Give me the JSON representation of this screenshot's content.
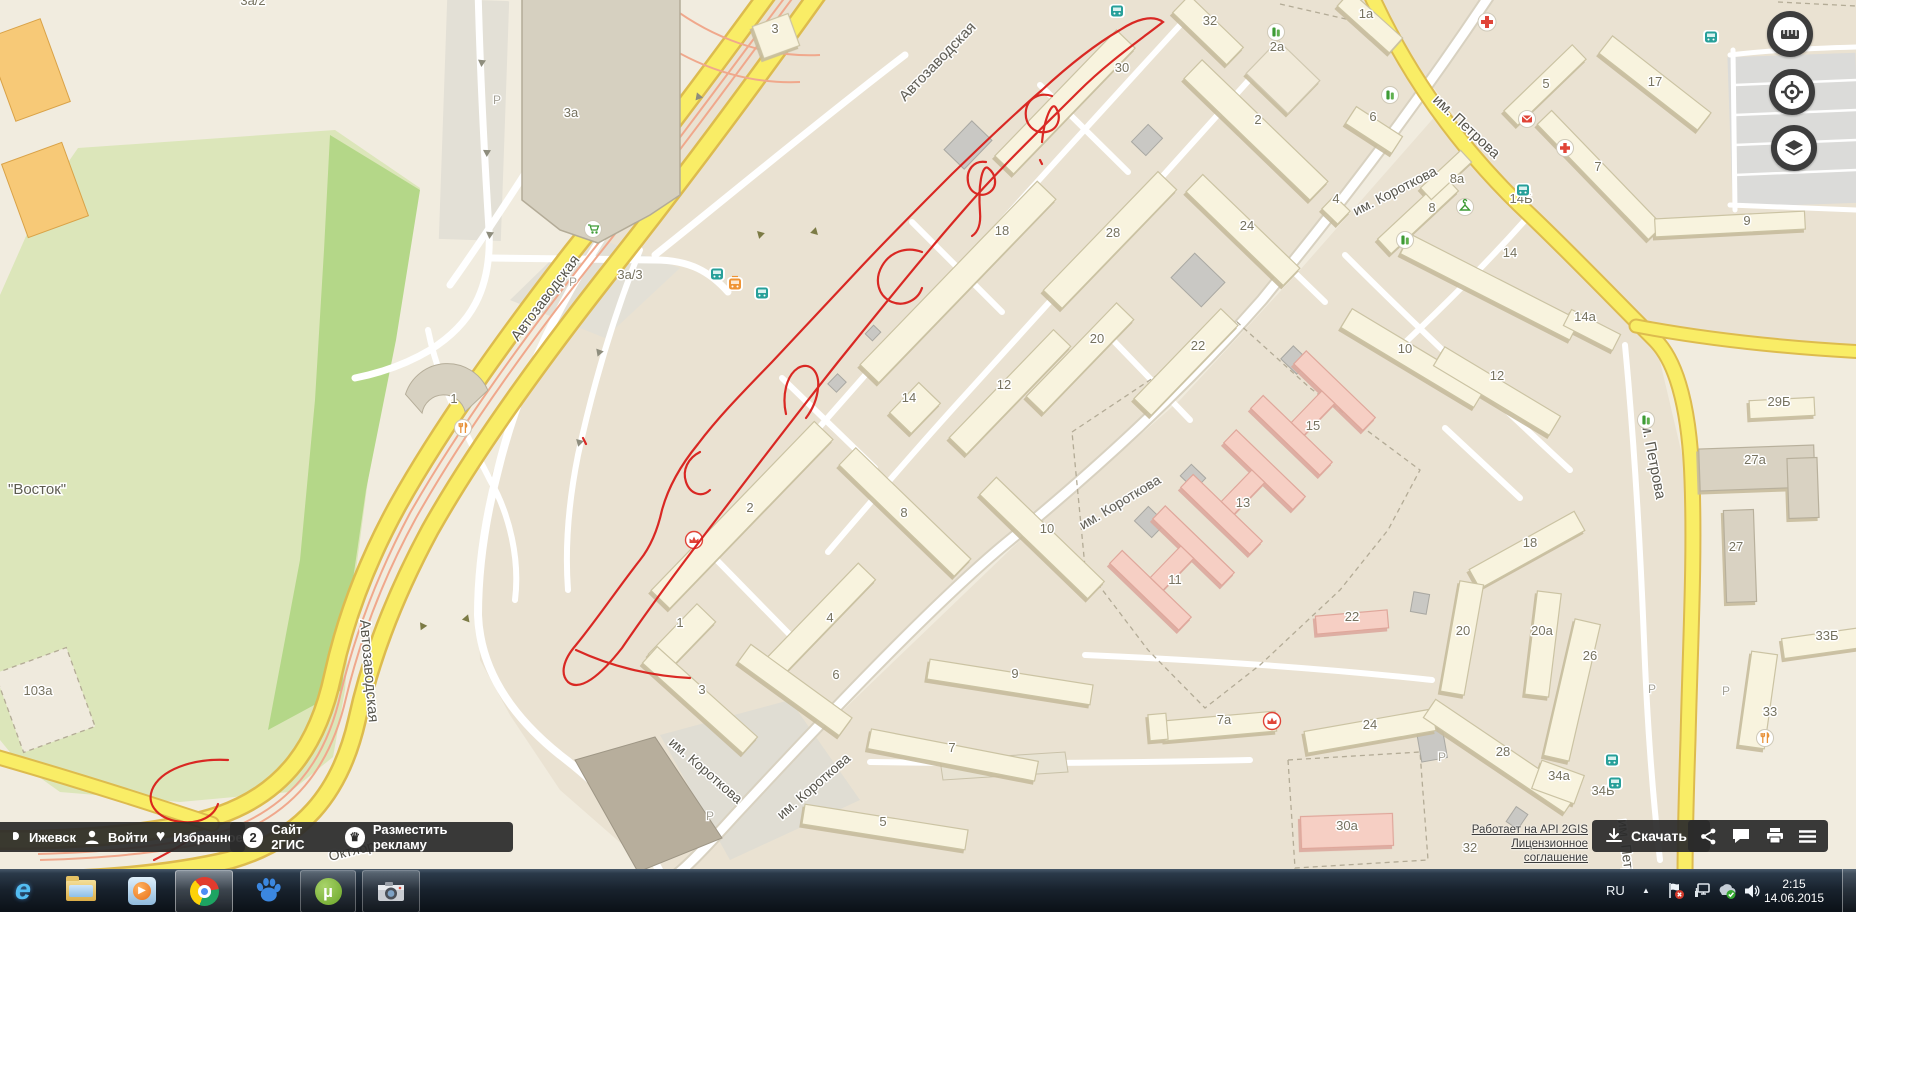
{
  "ui": {
    "bottom_bar": {
      "city": "Ижевск",
      "login": "Войти",
      "favorites": "Избранное",
      "site": "Сайт 2ГИС",
      "advertise": "Разместить рекламу",
      "site_logo_glyph": "2",
      "crown_glyph": "♛",
      "heart_glyph": "♥"
    },
    "attribution": {
      "api_link": "Работает на API 2GIS",
      "license_link": "Лицензионное соглашение",
      "download": "Скачать"
    },
    "tray": {
      "lang": "RU",
      "caret": "▲",
      "time": "2:15",
      "date": "14.06.2015"
    },
    "taskbar_icons": [
      "internet-explorer",
      "windows-explorer",
      "media-player",
      "chrome",
      "baidu",
      "utorrent",
      "screenshot-tool"
    ],
    "map_control_icons": [
      "ruler",
      "locate",
      "layers"
    ],
    "utorrent_glyph": "µ",
    "ie_glyph": "e"
  },
  "map": {
    "park_label": "\"Восток\"",
    "street_labels": [
      {
        "t": "Автозаводская",
        "x": 905,
        "y": 102,
        "r": -46,
        "s": 15
      },
      {
        "t": "Автозаводская",
        "x": 518,
        "y": 342,
        "r": -53,
        "s": 15
      },
      {
        "t": "Автозаводская",
        "x": 360,
        "y": 620,
        "r": 85,
        "s": 15
      },
      {
        "t": "им. Короткова",
        "x": 1356,
        "y": 216,
        "r": -27,
        "s": 14
      },
      {
        "t": "им. Короткова",
        "x": 1083,
        "y": 530,
        "r": -31,
        "s": 14
      },
      {
        "t": "им. Короткова",
        "x": 668,
        "y": 744,
        "r": 41,
        "s": 14
      },
      {
        "t": "им. Короткова",
        "x": 782,
        "y": 820,
        "r": -41,
        "s": 14
      },
      {
        "t": "им. Петрова",
        "x": 1432,
        "y": 101,
        "r": 43,
        "s": 15
      },
      {
        "t": "им. Петрова",
        "x": 1640,
        "y": 416,
        "r": 79,
        "s": 15
      },
      {
        "t": "им. Петрова",
        "x": 1618,
        "y": 820,
        "r": 83,
        "s": 14
      },
      {
        "t": "Октября",
        "x": 330,
        "y": 861,
        "r": -14,
        "s": 14
      }
    ],
    "building_labels": [
      {
        "t": "30",
        "x": 1122,
        "y": 72
      },
      {
        "t": "18",
        "x": 1002,
        "y": 235
      },
      {
        "t": "28",
        "x": 1113,
        "y": 237
      },
      {
        "t": "2",
        "x": 1258,
        "y": 124
      },
      {
        "t": "24",
        "x": 1247,
        "y": 230
      },
      {
        "t": "32",
        "x": 1210,
        "y": 25
      },
      {
        "t": "2а",
        "x": 1277,
        "y": 51
      },
      {
        "t": "4",
        "x": 1336,
        "y": 203
      },
      {
        "t": "20",
        "x": 1097,
        "y": 343
      },
      {
        "t": "22",
        "x": 1198,
        "y": 350
      },
      {
        "t": "12",
        "x": 1004,
        "y": 389
      },
      {
        "t": "14",
        "x": 909,
        "y": 402
      },
      {
        "t": "8",
        "x": 904,
        "y": 517
      },
      {
        "t": "10",
        "x": 1047,
        "y": 533
      },
      {
        "t": "2",
        "x": 750,
        "y": 512
      },
      {
        "t": "1",
        "x": 680,
        "y": 627
      },
      {
        "t": "4",
        "x": 830,
        "y": 622
      },
      {
        "t": "6",
        "x": 836,
        "y": 679
      },
      {
        "t": "3",
        "x": 702,
        "y": 694
      },
      {
        "t": "9",
        "x": 1015,
        "y": 678
      },
      {
        "t": "7",
        "x": 952,
        "y": 752
      },
      {
        "t": "5",
        "x": 883,
        "y": 826
      },
      {
        "t": "10",
        "x": 1405,
        "y": 353
      },
      {
        "t": "12",
        "x": 1497,
        "y": 380
      },
      {
        "t": "15",
        "x": 1313,
        "y": 430
      },
      {
        "t": "13",
        "x": 1243,
        "y": 507
      },
      {
        "t": "11",
        "x": 1175,
        "y": 584
      },
      {
        "t": "22",
        "x": 1352,
        "y": 621
      },
      {
        "t": "18",
        "x": 1530,
        "y": 547
      },
      {
        "t": "20",
        "x": 1463,
        "y": 635
      },
      {
        "t": "20а",
        "x": 1542,
        "y": 635
      },
      {
        "t": "7а",
        "x": 1224,
        "y": 724
      },
      {
        "t": "24",
        "x": 1370,
        "y": 729
      },
      {
        "t": "26",
        "x": 1590,
        "y": 660
      },
      {
        "t": "28",
        "x": 1503,
        "y": 756
      },
      {
        "t": "34а",
        "x": 1559,
        "y": 780
      },
      {
        "t": "34Б",
        "x": 1603,
        "y": 795
      },
      {
        "t": "30а",
        "x": 1347,
        "y": 830
      },
      {
        "t": "32",
        "x": 1470,
        "y": 852
      },
      {
        "t": "29Б",
        "x": 1779,
        "y": 406
      },
      {
        "t": "27а",
        "x": 1755,
        "y": 464
      },
      {
        "t": "27",
        "x": 1736,
        "y": 551
      },
      {
        "t": "33Б",
        "x": 1827,
        "y": 640
      },
      {
        "t": "33",
        "x": 1770,
        "y": 716
      },
      {
        "t": "14",
        "x": 1510,
        "y": 257
      },
      {
        "t": "14а",
        "x": 1585,
        "y": 321
      },
      {
        "t": "14Б",
        "x": 1521,
        "y": 203
      },
      {
        "t": "8а",
        "x": 1457,
        "y": 183
      },
      {
        "t": "8",
        "x": 1432,
        "y": 212
      },
      {
        "t": "5",
        "x": 1546,
        "y": 88
      },
      {
        "t": "17",
        "x": 1655,
        "y": 86
      },
      {
        "t": "7",
        "x": 1598,
        "y": 171
      },
      {
        "t": "9",
        "x": 1747,
        "y": 225
      },
      {
        "t": "1а",
        "x": 1366,
        "y": 18
      },
      {
        "t": "6",
        "x": 1373,
        "y": 121
      },
      {
        "t": "3а",
        "x": 571,
        "y": 117
      },
      {
        "t": "3",
        "x": 775,
        "y": 33
      },
      {
        "t": "3а/2",
        "x": 253,
        "y": 5
      },
      {
        "t": "3а/3",
        "x": 630,
        "y": 279
      },
      {
        "t": "1",
        "x": 454,
        "y": 403
      },
      {
        "t": "103а",
        "x": 38,
        "y": 695
      },
      {
        "t": "13",
        "x": 1799,
        "y": 104
      }
    ],
    "parking_letter": "P",
    "parking_positions": [
      {
        "x": 497,
        "y": 104
      },
      {
        "x": 573,
        "y": 286
      },
      {
        "x": 710,
        "y": 820
      },
      {
        "x": 1442,
        "y": 761
      },
      {
        "x": 1652,
        "y": 693
      },
      {
        "x": 1726,
        "y": 695
      }
    ],
    "poi": [
      {
        "kind": "bus",
        "x": 717,
        "y": 274
      },
      {
        "kind": "tram",
        "x": 735,
        "y": 284
      },
      {
        "kind": "bus",
        "x": 762,
        "y": 293
      },
      {
        "kind": "bus",
        "x": 1117,
        "y": 11
      },
      {
        "kind": "bus",
        "x": 1711,
        "y": 37
      },
      {
        "kind": "bus",
        "x": 1523,
        "y": 190
      },
      {
        "kind": "bus",
        "x": 1612,
        "y": 760
      },
      {
        "kind": "bus",
        "x": 1615,
        "y": 783
      },
      {
        "kind": "hospital",
        "x": 1487,
        "y": 22
      },
      {
        "kind": "post",
        "x": 1527,
        "y": 119
      },
      {
        "kind": "pharmacy",
        "x": 1565,
        "y": 148
      },
      {
        "kind": "shop",
        "x": 1276,
        "y": 32
      },
      {
        "kind": "shop",
        "x": 1390,
        "y": 95
      },
      {
        "kind": "shop",
        "x": 1405,
        "y": 240
      },
      {
        "kind": "shop",
        "x": 1646,
        "y": 420
      },
      {
        "kind": "clothes",
        "x": 1465,
        "y": 207
      },
      {
        "kind": "attraction",
        "x": 694,
        "y": 540
      },
      {
        "kind": "attraction",
        "x": 1272,
        "y": 721
      },
      {
        "kind": "cart",
        "x": 593,
        "y": 229
      },
      {
        "kind": "food",
        "x": 463,
        "y": 428
      },
      {
        "kind": "food",
        "x": 1765,
        "y": 738
      }
    ],
    "colors": {
      "road_yellow": "#f9ed66",
      "road_casing": "#ddbb4e",
      "tram_line": "#f0a88c",
      "park_light": "#dce6ba",
      "park_bright": "#b4d788",
      "building": "#f8f3de",
      "hospital_pink": "#f6cfc4",
      "annotation_red": "#d81e1a",
      "block": "#eae2d2"
    }
  }
}
